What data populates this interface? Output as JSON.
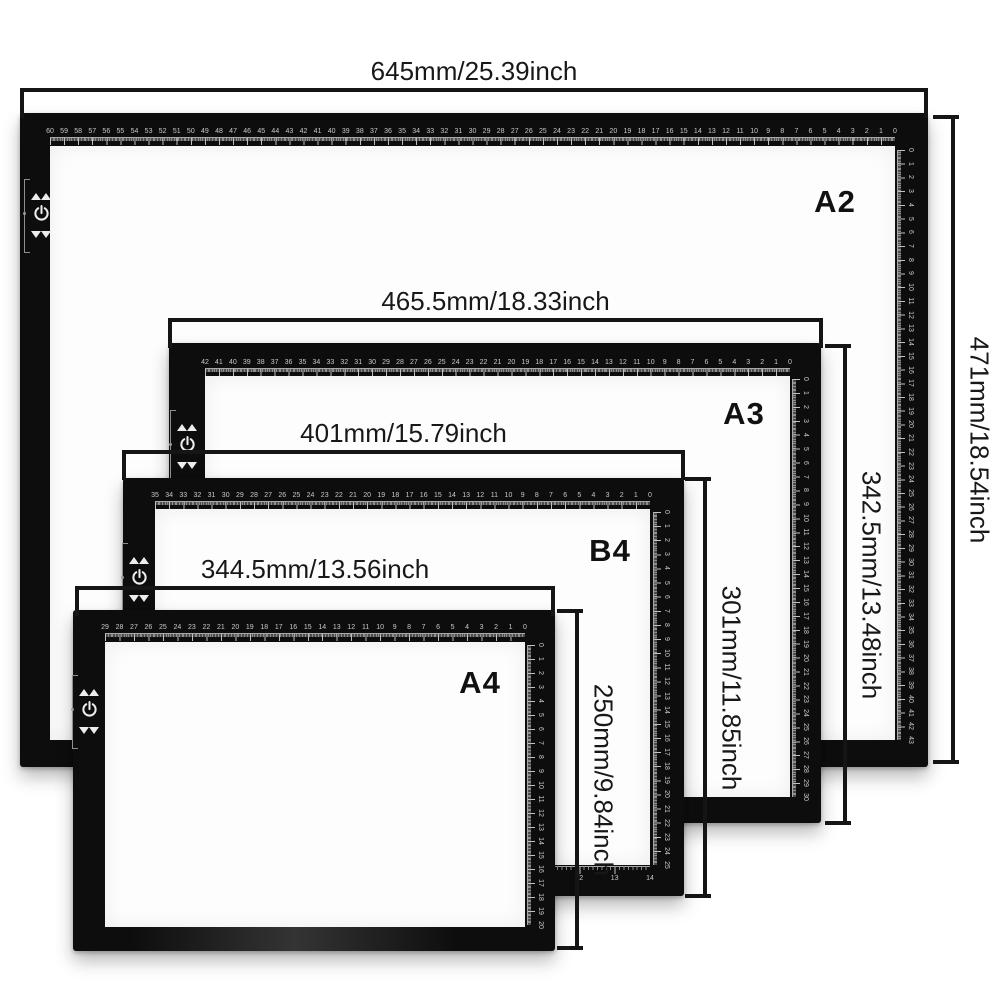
{
  "diagram": {
    "boards": [
      {
        "id": "a2",
        "label": "A2",
        "width_label": "645mm/25.39inch",
        "height_label": "471mm/18.54inch",
        "rulers": {
          "top": {
            "from": 60,
            "to": 0,
            "unit": "cm"
          },
          "right": {
            "from": 0,
            "to": 43,
            "unit": "cm"
          }
        }
      },
      {
        "id": "a3",
        "label": "A3",
        "width_label": "465.5mm/18.33inch",
        "height_label": "342.5mm/13.48inch",
        "rulers": {
          "top": {
            "from": 42,
            "to": 0,
            "unit": "cm"
          },
          "right": {
            "from": 0,
            "to": 30,
            "unit": "cm"
          }
        }
      },
      {
        "id": "b4",
        "label": "B4",
        "width_label": "401mm/15.79inch",
        "height_label": "301mm/11.85inch",
        "rulers": {
          "top": {
            "from": 35,
            "to": 0,
            "unit": "cm"
          },
          "right": {
            "from": 0,
            "to": 25,
            "unit": "cm"
          },
          "bottom": {
            "from": 0,
            "to": 14,
            "unit": "inch"
          }
        }
      },
      {
        "id": "a4",
        "label": "A4",
        "width_label": "344.5mm/13.56inch",
        "height_label": "250mm/9.84inch",
        "rulers": {
          "top": {
            "from": 29,
            "to": 0,
            "unit": "cm"
          },
          "right": {
            "from": 0,
            "to": 20,
            "unit": "cm"
          }
        }
      }
    ],
    "controls": {
      "icons": [
        "brightness-up-icon",
        "power-icon",
        "brightness-down-icon"
      ]
    },
    "colors": {
      "board_frame": "#0d0d0d",
      "board_screen": "#fdfdfd",
      "annotation": "#151515",
      "ruler_marks": "#c9c9c9"
    }
  }
}
